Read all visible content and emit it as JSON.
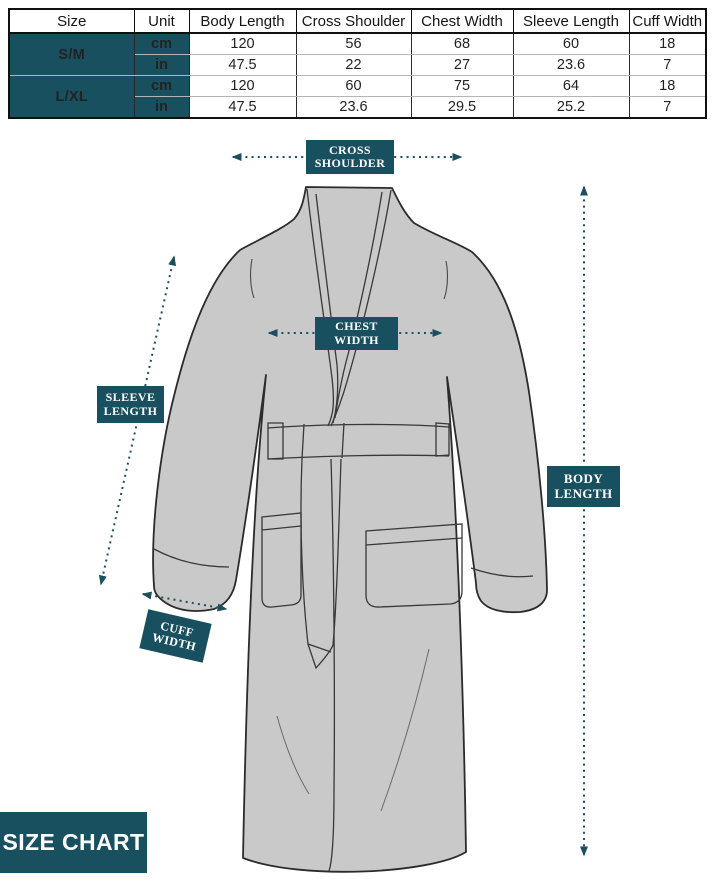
{
  "colors": {
    "accent_teal": "#19505f",
    "robe_fill": "#c9c9c9",
    "robe_outline": "#2b2b2b"
  },
  "table": {
    "columns": [
      "Size",
      "Unit",
      "Body Length",
      "Cross Shoulder",
      "Chest Width",
      "Sleeve Length",
      "Cuff Width"
    ],
    "groups": [
      {
        "size": "S/M",
        "rows": [
          {
            "unit": "cm",
            "values": [
              "120",
              "56",
              "68",
              "60",
              "18"
            ]
          },
          {
            "unit": "in",
            "values": [
              "47.5",
              "22",
              "27",
              "23.6",
              "7"
            ]
          }
        ]
      },
      {
        "size": "L/XL",
        "rows": [
          {
            "unit": "cm",
            "values": [
              "120",
              "60",
              "75",
              "64",
              "18"
            ]
          },
          {
            "unit": "in",
            "values": [
              "47.5",
              "23.6",
              "29.5",
              "25.2",
              "7"
            ]
          }
        ]
      }
    ]
  },
  "diagram": {
    "labels": {
      "cross_shoulder": "CROSS SHOULDER",
      "chest_width": "CHEST WIDTH",
      "sleeve_length": "SLEEVE LENGTH",
      "body_length": "BODY LENGTH",
      "cuff_width": "CUFF WIDTH"
    }
  },
  "footer": {
    "title": "SIZE CHART"
  }
}
